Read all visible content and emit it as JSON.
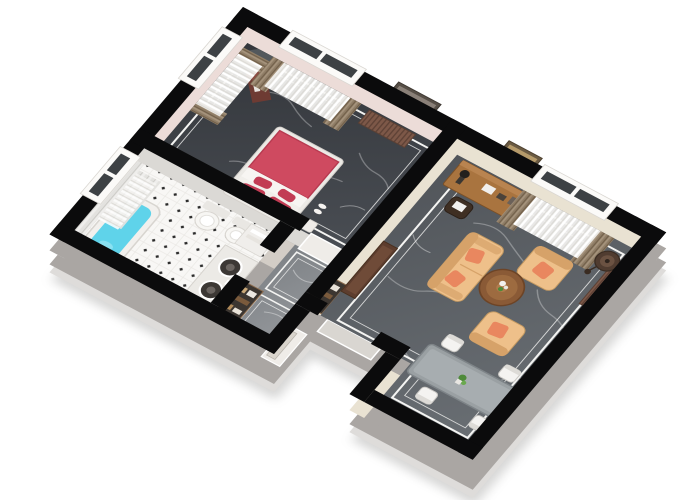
{
  "meta": {
    "description": "3D isometric cutaway floor plan rendering of a one-bedroom apartment, viewed from above at an angle, on a white background. No text labels are visible.",
    "background": "#ffffff"
  },
  "palette": {
    "wall-top": "#0b0b0c",
    "facade": "#aaa6a3",
    "facade-light": "#dedcda",
    "bedroom-wall": "#ecdcd8",
    "living-wall": "#e9e2d2",
    "bath-wall": "#dbd9d5",
    "hall-wall": "#d3cdc6",
    "bedroom-floor-a": "#303338",
    "bedroom-floor-b": "#4a4e54",
    "living-floor-a": "#4e5257",
    "living-floor-b": "#686d72",
    "hall-floor-a": "#7c8084",
    "hall-floor-b": "#93969a",
    "marble-vein": "#ffffff",
    "rug-line": "#f4f4f2",
    "bed-red": "#cf4a60",
    "pillow-red": "#c23c54",
    "soft-white": "#f4f2ef",
    "sofa-tan": "#eec08a",
    "sofa-tan-dark": "#d6a269",
    "cushion-orange": "#e9875f",
    "desk-wood": "#a9743f",
    "wood-dark": "#6d4426",
    "maroon": "#6e3b33",
    "table-gray": "#9aa0a3",
    "chair-white": "#f4f3f1",
    "tub-water": "#5fd3ea",
    "window-glass": "#3d4144",
    "sheer-white": "#f7f6f3",
    "drape-brown": "#8f7d66",
    "drape-brown-dark": "#6f5d47",
    "radiator-brown": "#7d5848",
    "lamp-brown": "#503c30",
    "plant-green": "#4e8a3a",
    "niche-dark": "#3c3631",
    "sink-dark": "#3c3835",
    "tv-gray": "#53585c",
    "tile-white": "#f8f7f5",
    "tile-dot": "#2b2b2b"
  },
  "scene": {
    "type": "isometric-floor-plan",
    "rooms": [
      {
        "id": "bedroom",
        "floor": "black-marble",
        "furniture": [
          "double-bed-red-duvet",
          "red-pillows-x4",
          "corner-tv-panel",
          "maroon-dresser",
          "wall-picture",
          "radiator",
          "window-west",
          "window-north",
          "sheer-curtains",
          "brown-drapes",
          "nightstand",
          "slippers"
        ]
      },
      {
        "id": "bathroom",
        "floor": "white-tile-black-diamonds",
        "furniture": [
          "bathtub-cyan-water",
          "toilet",
          "bidet",
          "vanity-counter",
          "round-sinks-x2",
          "towel-shelf",
          "window-west",
          "marble-wall-panel",
          "open-door"
        ]
      },
      {
        "id": "hallway",
        "floor": "gray-marble",
        "furniture": [
          "rug-outline-x2",
          "wardrobe-niche-x2",
          "entry-door",
          "threshold-to-living",
          "threshold-to-bedroom"
        ]
      },
      {
        "id": "living-room",
        "floor": "gray-marble-dark",
        "furniture": [
          "desk",
          "desk-lamp",
          "desk-chair",
          "wall-picture",
          "window-north",
          "sheer-curtains",
          "brown-drapes",
          "radiator-east",
          "floor-lamp",
          "sofa-2-seat",
          "armchair-x2",
          "orange-cushions-x4",
          "round-coffee-table",
          "flower-vase",
          "dining-table",
          "dining-chairs-x4",
          "table-plant",
          "sideboard-cabinet"
        ]
      }
    ],
    "counts": {
      "windows": 4,
      "doors": 3,
      "seats": 7,
      "orange-cushions": 4
    }
  }
}
